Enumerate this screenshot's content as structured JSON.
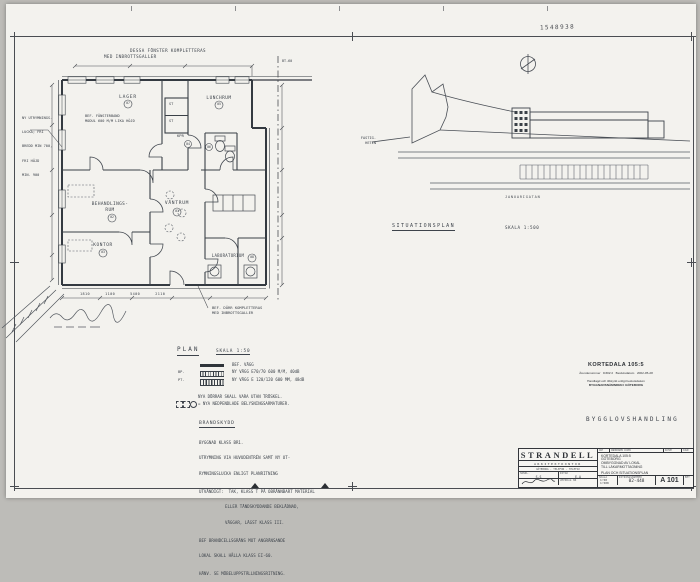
{
  "meta": {
    "doc_number": "1548938"
  },
  "plan": {
    "title": "PLAN",
    "scale": "SKALA 1:50",
    "top_note_1": "DESSA FÖNSTER KOMPLETTERAS",
    "top_note_2": "MED INBROTTSGALLER",
    "top_dim_mark": "BT-60",
    "left_note": {
      "l1": "NY UTRYMNINGS-",
      "l2": "LUCKA; FRI",
      "l3": "BREDD MIN 700,",
      "l4": "FRI HÖJD",
      "l5": "MIN. 900"
    },
    "window_note_1": "BEF. FÖNSTERBAND",
    "window_note_2": "MODUL 600 M/M LIKA HÖJD",
    "door_note_1": "BEF. DÖRR KOMPLETTERAS",
    "door_note_2": "MED INBROTTSGALLER",
    "dim_row": "1810      1100      5400      2110",
    "rooms": {
      "lager": {
        "label": "LAGER",
        "num": "07"
      },
      "lunchrum": {
        "label": "LUNCHRUM",
        "num": "05"
      },
      "st1": {
        "label": "ST"
      },
      "st2": {
        "label": "ST"
      },
      "kpr": {
        "label": "KPR",
        "num": "04"
      },
      "wc": {
        "num": "06"
      },
      "behandling": {
        "label": "BEHANDLINGS-",
        "label2": "RUM",
        "num": "02"
      },
      "vantrum": {
        "label": "VÄNTRUM",
        "num": "01"
      },
      "kontor": {
        "label": "KONTOR",
        "num": "03"
      },
      "laboratorium": {
        "label": "LABORATORIUM",
        "num": "08"
      }
    },
    "legend": [
      {
        "tag": "",
        "text": "BEF. VÄGG"
      },
      {
        "tag": "BP.",
        "text": "NY VÄGG E70/70 600 M/M, 40dB"
      },
      {
        "tag": "PT.",
        "text": "NY VÄGG E 120/120 600 MM, 48dB"
      }
    ],
    "note1": "NYA DÖRRAR SKALL VARA UTAN TRÖSKEL.",
    "note2": "= NYA NEDPENDLADE BELYSNINGSARMATURER.",
    "brandskydd": {
      "heading": "BRANDSKYDD",
      "lines": [
        "BYGGNAD KLASS BR1.",
        "UTRYMNING VIA HUVUDENTRÉN SAMT NY UT-",
        "RYMNINGSLUCKA ENLIGT PLANRITNING",
        "UTVÄNDIGT:  TAK, KLASS T PÅ OBRÄNNBART MATERIAL",
        "ELLER TÄNDSKYDDANDE BEKLÄDNAD,",
        "VÄGGAR, LÄGST KLASS III.",
        "BEF BRANDCELLSGRÄNS MOT ANGRÄNSANDE",
        "LOKAL SKALL HÅLLA KLASS EI-60.",
        "HÄNV. SE MÖBELUPPSTÄLLNINGSRITNING."
      ]
    }
  },
  "siteplan": {
    "title": "SITUATIONSPLAN",
    "scale": "SKALA 1:500",
    "street": "JANUARIGATAN",
    "area_label_1": "FASTIG-",
    "area_label_2": "HETEN"
  },
  "stamp": {
    "title": "KORTEDALA 105:5",
    "row": "Ärendenummer   D302:2   Beslutsdatum   2002-05-28",
    "line1": "Handlagd och tillstyrkt enligt beslutsdatum",
    "line2": "BYGGNADSNÄMNDEN I GÖTEBORG",
    "watermark": "BYGGLOVSHANDLING"
  },
  "titleblock": {
    "firm": "STRANDELL",
    "firm2": "ARKITEKTKONTOR",
    "address": "GÖTEBORG · TELEFON · TELEFAX",
    "handl_label": "HANDL.",
    "handl": "S.S",
    "ritad_label": "RITAD",
    "ritad": "E.A",
    "uppdrag_label": "UPPDRAG NR",
    "rev1": "ANT",
    "rev2": "ÄNDRINGEN AVSER",
    "rev3": "DATUM",
    "rev4": "SIGN",
    "project1": "KORTEDALA 105:5",
    "project2": "GÖTEBORG",
    "project3": "OMBYGGNAD AV LOKAL",
    "project4": "TILL LÄKARMOTTAGNING",
    "content": "PLAN OCH SITUATIONSPLAN",
    "skala_label": "SKALA",
    "skala1": "1:50",
    "skala2": "1:500",
    "ritnr_label": "RITNINGSNUMMER",
    "ritnr": "02-448",
    "sheet": "A 101",
    "bet_label": "BET"
  }
}
